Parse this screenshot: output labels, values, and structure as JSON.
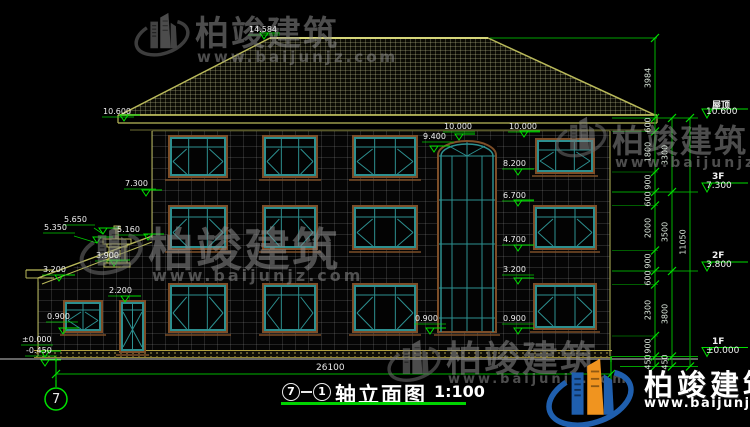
{
  "watermark": {
    "brand": "柏竣建筑",
    "url": "www.baijunjz.com"
  },
  "corner_logo": {
    "brand": "柏竣建筑",
    "url": "www.baijunjz.com"
  },
  "title_bar": {
    "axis_start": "7",
    "axis_end": "1",
    "title": "轴立面图",
    "scale": "1:100"
  },
  "grid": {
    "left_bubble": "7"
  },
  "dimensions": {
    "total_width": "26100",
    "roof_height": "3984",
    "right_total": "11050",
    "right_detail": [
      "600",
      "1800",
      "900",
      "600",
      "2000",
      "900",
      "600",
      "2300",
      "900",
      "450"
    ],
    "right_floors": [
      "3300",
      "3500",
      "3800",
      "450"
    ]
  },
  "level_markers": [
    {
      "name": "屋顶",
      "elev": "10.600",
      "y": 118
    },
    {
      "name": "3F",
      "elev": "7.300",
      "y": 192
    },
    {
      "name": "2F",
      "elev": "3.800",
      "y": 271
    },
    {
      "name": "1F",
      "elev": "±0.000",
      "y": 356.5
    }
  ],
  "spot_elevations": [
    {
      "value": "14.584",
      "x": 249,
      "y": 25,
      "ax": 264,
      "ay": 39
    },
    {
      "value": "10.600",
      "x": 103,
      "y": 107,
      "ax": 124,
      "ay": 121
    },
    {
      "value": "10.000",
      "x": 444,
      "y": 122,
      "ax": 459,
      "ay": 140
    },
    {
      "value": "10.000",
      "x": 509,
      "y": 122,
      "ax": 524,
      "ay": 137
    },
    {
      "value": "9.400",
      "x": 423,
      "y": 132,
      "ax": 434,
      "ay": 152
    },
    {
      "value": "8.200",
      "x": 503,
      "y": 159,
      "ax": 518,
      "ay": 175
    },
    {
      "value": "6.700",
      "x": 503,
      "y": 191,
      "ax": 518,
      "ay": 206
    },
    {
      "value": "4.700",
      "x": 503,
      "y": 235,
      "ax": 518,
      "ay": 251
    },
    {
      "value": "3.200",
      "x": 503,
      "y": 265,
      "ax": 518,
      "ay": 284
    },
    {
      "value": "0.900",
      "x": 503,
      "y": 314,
      "ax": 518,
      "ay": 334
    },
    {
      "value": "0.900",
      "x": 415,
      "y": 314,
      "ax": 430,
      "ay": 334
    },
    {
      "value": "7.300",
      "x": 125,
      "y": 179,
      "ax": 146,
      "ay": 196
    },
    {
      "value": "5.650",
      "x": 64,
      "y": 215,
      "ax": 103,
      "ay": 234
    },
    {
      "value": "5.350",
      "x": 44,
      "y": 223,
      "ax": 97,
      "ay": 243
    },
    {
      "value": "5.160",
      "x": 117,
      "y": 225,
      "ax": 148,
      "ay": 240
    },
    {
      "value": "3.900",
      "x": 96,
      "y": 251,
      "ax": 114,
      "ay": 266
    },
    {
      "value": "3.200",
      "x": 43,
      "y": 265,
      "ax": 59,
      "ay": 281
    },
    {
      "value": "2.200",
      "x": 109,
      "y": 286,
      "ax": 125,
      "ay": 302
    },
    {
      "value": "0.900",
      "x": 47,
      "y": 312,
      "ax": 63,
      "ay": 334
    },
    {
      "value": "±0.000",
      "x": 22,
      "y": 335,
      "ax": 45,
      "ay": 357
    },
    {
      "value": "-0.450",
      "x": 26,
      "y": 346,
      "ax": 45,
      "ay": 366
    }
  ]
}
